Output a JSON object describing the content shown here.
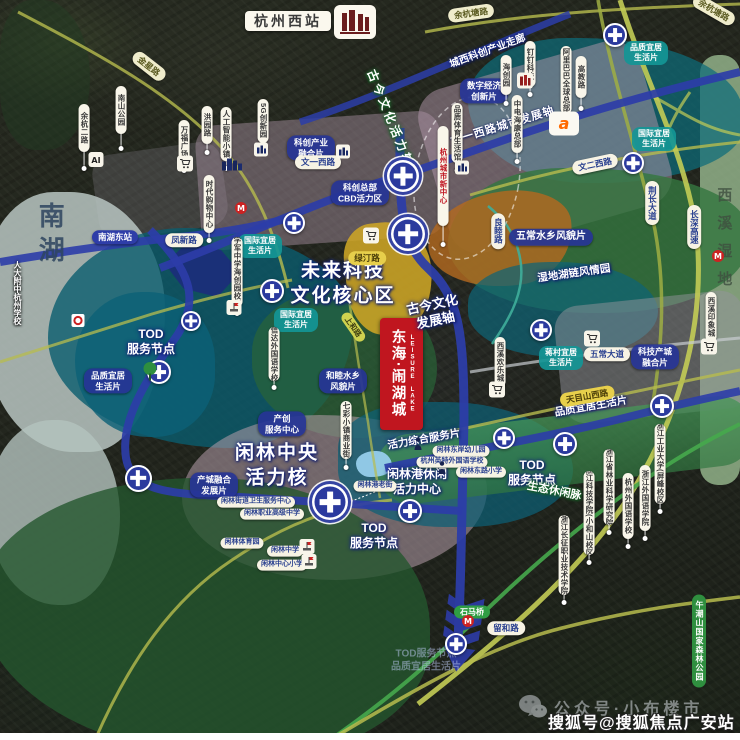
{
  "header": {
    "west_station": "杭州西站"
  },
  "project_banner": {
    "cn": "东海·闹湖城",
    "en": "LEISURE LAKE"
  },
  "watermarks": {
    "wechat": "公众号·小布楼市",
    "sohu": "搜狐号@搜狐焦点广安站"
  },
  "colors": {
    "metro": "#2c3da8",
    "road_olive": "#b7bc4e",
    "road_green": "#46a84c",
    "banner_red": "#c0161f",
    "station_blue": "#2b3a9e",
    "zone_teal": "#0e6476",
    "zone_green": "#34763f",
    "zone_yellow": "#cda526",
    "lake": "#bac6c2"
  },
  "labels": {
    "axis": [
      {
        "c": "halo-blue big",
        "t": "未来科技\n文化核心区",
        "x": 343,
        "y": 284,
        "f": 19
      },
      {
        "c": "halo-blue big",
        "t": "闲林中央\n活力核",
        "x": 277,
        "y": 466,
        "f": 19
      },
      {
        "c": "halo-blue",
        "t": "TOD\n服务节点",
        "x": 151,
        "y": 342,
        "f": 12
      },
      {
        "c": "halo-blue",
        "t": "TOD\n服务节点",
        "x": 532,
        "y": 473,
        "f": 12
      },
      {
        "c": "halo-blue",
        "t": "TOD\n服务节点",
        "x": 374,
        "y": 536,
        "f": 12
      },
      {
        "c": "halo-blue",
        "t": "闲林港休闲\n活力中心",
        "x": 417,
        "y": 482,
        "f": 12
      },
      {
        "c": "halo-blue",
        "t": "古今文化\n发展轴",
        "x": 434,
        "y": 313,
        "f": 13,
        "r": -12
      },
      {
        "c": "halo-green ax",
        "t": "古今文化活力轴",
        "x": 390,
        "y": 119,
        "f": 12,
        "r": 68
      },
      {
        "c": "on-band",
        "t": "文一西路城市发展轴",
        "x": 503,
        "y": 127,
        "f": 11,
        "r": -17
      },
      {
        "c": "halo-blue",
        "t": "城西科创产业走廊",
        "x": 488,
        "y": 52,
        "f": 10,
        "r": -20
      },
      {
        "c": "halo-blue",
        "t": "湿地湖链风情园",
        "x": 574,
        "y": 274,
        "f": 10.5,
        "r": -8
      },
      {
        "c": "halo-green",
        "t": "生态休闲脉",
        "x": 554,
        "y": 492,
        "f": 11,
        "r": 11
      },
      {
        "c": "halo-blue",
        "t": "活力综合服务片",
        "x": 424,
        "y": 440,
        "f": 10.5,
        "r": -10
      },
      {
        "c": "halo-blue",
        "t": "品质宜居生活片",
        "x": 591,
        "y": 407,
        "f": 10.5,
        "r": -10
      },
      {
        "c": "faded",
        "t": "TOD服务节点\n品质宜居生活片",
        "x": 426,
        "y": 661,
        "f": 10
      }
    ],
    "area_names": [
      {
        "c": "area-lake",
        "t": "南湖",
        "x": 50,
        "y": 236,
        "f": 26,
        "ls": 8
      },
      {
        "c": "area-wet",
        "t": "西溪湿地",
        "x": 723,
        "y": 243,
        "f": 15,
        "ls": 13
      }
    ],
    "zone_tags": [
      {
        "c": "btag",
        "t": "科创产业\n融合片",
        "x": 311,
        "y": 148
      },
      {
        "c": "btag",
        "t": "科创总部\nCBD活力区",
        "x": 360,
        "y": 193
      },
      {
        "c": "btag",
        "t": "数字经济\n创新片",
        "x": 484,
        "y": 91
      },
      {
        "c": "btag",
        "t": "品质宜居\n生活片",
        "x": 108,
        "y": 381
      },
      {
        "c": "btag",
        "t": "产创\n服务中心",
        "x": 282,
        "y": 424
      },
      {
        "c": "btag",
        "t": "产城融合\n发展片",
        "x": 214,
        "y": 485
      },
      {
        "c": "btag",
        "t": "和睦水乡\n风貌片",
        "x": 343,
        "y": 381
      },
      {
        "c": "btag",
        "t": "五常水乡风貌片",
        "x": 551,
        "y": 237,
        "f": 10
      },
      {
        "c": "btag",
        "t": "科技产城\n融合片",
        "x": 655,
        "y": 357
      },
      {
        "c": "ttag",
        "t": "品质宜居\n生活片",
        "x": 646,
        "y": 53
      },
      {
        "c": "ttag",
        "t": "国际宜居\n生活片",
        "x": 654,
        "y": 139
      },
      {
        "c": "ttag",
        "t": "国际宜居\n生活片",
        "x": 260,
        "y": 246
      },
      {
        "c": "ttag",
        "t": "国际宜居\n生活片",
        "x": 296,
        "y": 320
      },
      {
        "c": "ttag",
        "t": "蒋村宜居\n生活片",
        "x": 561,
        "y": 358
      }
    ],
    "road_labels": [
      {
        "c": "pill",
        "t": "凤新路",
        "x": 184,
        "y": 240
      },
      {
        "c": "pill",
        "t": "文一西路",
        "x": 318,
        "y": 162
      },
      {
        "c": "pill",
        "t": "文二西路",
        "x": 595,
        "y": 164,
        "r": -12
      },
      {
        "c": "pill",
        "t": "五常大道",
        "x": 607,
        "y": 354
      },
      {
        "c": "pill",
        "t": "留和路",
        "x": 506,
        "y": 628
      },
      {
        "c": "pill cream",
        "t": "余杭塘路",
        "x": 471,
        "y": 13,
        "r": -8
      },
      {
        "c": "pill cream",
        "t": "余杭塘路",
        "x": 714,
        "y": 10,
        "r": 30
      },
      {
        "c": "pill cream",
        "t": "金星路",
        "x": 149,
        "y": 66,
        "r": 38
      },
      {
        "c": "bluepill",
        "t": "南湖东站",
        "x": 115,
        "y": 237
      },
      {
        "c": "ypill",
        "t": "天目山西路",
        "x": 587,
        "y": 396,
        "r": -10
      },
      {
        "c": "ypill",
        "t": "绿汀路",
        "x": 367,
        "y": 258
      },
      {
        "c": "opill",
        "t": "上和路",
        "x": 353,
        "y": 327,
        "r": 55
      },
      {
        "c": "gpill",
        "t": "石马桥",
        "x": 472,
        "y": 612
      },
      {
        "c": "vroad",
        "t": "荆长大道",
        "x": 652,
        "y": 203
      },
      {
        "c": "vroad",
        "t": "长深高速",
        "x": 694,
        "y": 227
      },
      {
        "c": "vroad",
        "t": "良睦路",
        "x": 498,
        "y": 231
      },
      {
        "c": "vgreen",
        "t": "午潮山国家森林公园",
        "x": 699,
        "y": 641
      }
    ],
    "poi_labels": [
      {
        "c": "pill sm",
        "t": "闲林港老街",
        "x": 375,
        "y": 486
      },
      {
        "c": "pill sm",
        "t": "闲林东岸幼儿园",
        "x": 461,
        "y": 451
      },
      {
        "c": "pill sm",
        "t": "杭州英特外国语学校",
        "x": 452,
        "y": 462
      },
      {
        "c": "pill sm",
        "t": "闲林东路小学",
        "x": 481,
        "y": 472
      },
      {
        "c": "pill sm",
        "t": "闲林街道卫生服务中心",
        "x": 256,
        "y": 502
      },
      {
        "c": "pill sm",
        "t": "闲林职业高级中学",
        "x": 272,
        "y": 514
      },
      {
        "c": "pill sm",
        "t": "闲林体育园",
        "x": 242,
        "y": 543
      },
      {
        "c": "pill sm",
        "t": "闲林中学",
        "x": 285,
        "y": 551
      },
      {
        "c": "pill sm",
        "t": "闲林中心小学",
        "x": 282,
        "y": 565
      },
      {
        "c": "vtextw",
        "t": "人大附中杭州学校",
        "x": 17,
        "y": 293
      }
    ],
    "pins": [
      {
        "t": "杭州城市新中心",
        "x": 443,
        "y": 126,
        "h": 92,
        "s": 16,
        "red": 1
      },
      {
        "t": "阿里巴巴全球总部",
        "x": 566,
        "y": 46,
        "h": 60,
        "s": 6
      },
      {
        "t": "高教路",
        "x": 581,
        "y": 56,
        "h": 34,
        "s": 8
      },
      {
        "t": "海创园",
        "x": 506,
        "y": 55,
        "h": 32,
        "s": 6
      },
      {
        "t": "钉钉科技",
        "x": 530,
        "y": 41,
        "h": 38,
        "s": 5
      },
      {
        "t": "中电海康总部",
        "x": 517,
        "y": 95,
        "h": 50,
        "s": 6
      },
      {
        "t": "余杭二路",
        "x": 84,
        "y": 104,
        "h": 40,
        "s": 14
      },
      {
        "t": "南山公园",
        "x": 121,
        "y": 86,
        "h": 40,
        "s": 12
      },
      {
        "t": "万福广场",
        "x": 184,
        "y": 120,
        "h": 36,
        "s": 4
      },
      {
        "t": "洪园路",
        "x": 207,
        "y": 106,
        "h": 30,
        "s": 6
      },
      {
        "t": "人工智能小镇",
        "x": 226,
        "y": 107,
        "h": 46,
        "s": 5
      },
      {
        "t": "时代购物中心",
        "x": 209,
        "y": 175,
        "h": 50,
        "s": 5
      },
      {
        "t": "5G创新园",
        "x": 263,
        "y": 99,
        "h": 36,
        "s": 8
      },
      {
        "t": "学军中学海创园校区",
        "x": 237,
        "y": 237,
        "h": 62,
        "s": 4
      },
      {
        "t": "信达外国语学校",
        "x": 274,
        "y": 327,
        "h": 46,
        "s": 4
      },
      {
        "t": "七彩小镇商业街",
        "x": 346,
        "y": 401,
        "h": 50,
        "s": 6
      },
      {
        "t": "西溪欢乐城",
        "x": 500,
        "y": 337,
        "h": 42,
        "s": 5
      },
      {
        "t": "西溪印象城",
        "x": 711,
        "y": 292,
        "h": 42,
        "s": 5
      },
      {
        "t": "品质体育生活馆",
        "x": 457,
        "y": 103,
        "h": 52,
        "s": 5
      },
      {
        "t": "浙江工业大学(屏峰校区)",
        "x": 660,
        "y": 424,
        "h": 72,
        "s": 5
      },
      {
        "t": "浙江外国语学院",
        "x": 645,
        "y": 465,
        "h": 58,
        "s": 5
      },
      {
        "t": "杭州外国语学校",
        "x": 628,
        "y": 473,
        "h": 58,
        "s": 5
      },
      {
        "t": "浙江省林业科学研究院",
        "x": 609,
        "y": 449,
        "h": 68,
        "s": 5
      },
      {
        "t": "浙江科技学院(小和山校区)",
        "x": 589,
        "y": 471,
        "h": 76,
        "s": 5
      },
      {
        "t": "浙江长征职业技术学院",
        "x": 564,
        "y": 515,
        "h": 72,
        "s": 5
      }
    ]
  },
  "stations": [
    {
      "x": 615,
      "y": 35,
      "d": 24
    },
    {
      "x": 633,
      "y": 163,
      "d": 22
    },
    {
      "x": 403,
      "y": 176,
      "d": 32,
      "b": 1
    },
    {
      "x": 408,
      "y": 234,
      "d": 34,
      "b": 1
    },
    {
      "x": 294,
      "y": 223,
      "d": 22
    },
    {
      "x": 272,
      "y": 291,
      "d": 24
    },
    {
      "x": 191,
      "y": 321,
      "d": 20
    },
    {
      "x": 159,
      "y": 372,
      "d": 24
    },
    {
      "x": 138,
      "y": 478,
      "d": 27
    },
    {
      "x": 330,
      "y": 502,
      "d": 36,
      "b": 1
    },
    {
      "x": 410,
      "y": 511,
      "d": 24
    },
    {
      "x": 504,
      "y": 438,
      "d": 22
    },
    {
      "x": 565,
      "y": 444,
      "d": 24
    },
    {
      "x": 662,
      "y": 406,
      "d": 24
    },
    {
      "x": 541,
      "y": 330,
      "d": 22
    },
    {
      "x": 456,
      "y": 644,
      "d": 22
    }
  ],
  "icons": [
    {
      "k": "cart",
      "x": 371,
      "y": 238
    },
    {
      "k": "cart",
      "x": 185,
      "y": 166
    },
    {
      "k": "cart",
      "x": 497,
      "y": 392
    },
    {
      "k": "cart",
      "x": 709,
      "y": 349
    },
    {
      "k": "cart",
      "x": 592,
      "y": 341
    },
    {
      "k": "buildings",
      "x": 232,
      "y": 166
    },
    {
      "k": "landmark",
      "x": 525,
      "y": 83
    },
    {
      "k": "alibaba",
      "x": 564,
      "y": 126
    },
    {
      "k": "ai",
      "x": 96,
      "y": 162
    },
    {
      "k": "venue",
      "x": 261,
      "y": 152
    },
    {
      "k": "venue",
      "x": 343,
      "y": 154
    },
    {
      "k": "venue",
      "x": 462,
      "y": 170
    },
    {
      "k": "school",
      "x": 234,
      "y": 310
    },
    {
      "k": "school",
      "x": 307,
      "y": 549
    },
    {
      "k": "school",
      "x": 309,
      "y": 564
    },
    {
      "k": "figure",
      "x": 418,
      "y": 446
    },
    {
      "k": "figure",
      "x": 442,
      "y": 470
    },
    {
      "k": "tree",
      "x": 150,
      "y": 374
    },
    {
      "k": "metroM",
      "x": 468,
      "y": 623
    },
    {
      "k": "metroM",
      "x": 241,
      "y": 210
    },
    {
      "k": "metroM",
      "x": 718,
      "y": 258
    },
    {
      "k": "hwy",
      "x": 78,
      "y": 323
    }
  ]
}
